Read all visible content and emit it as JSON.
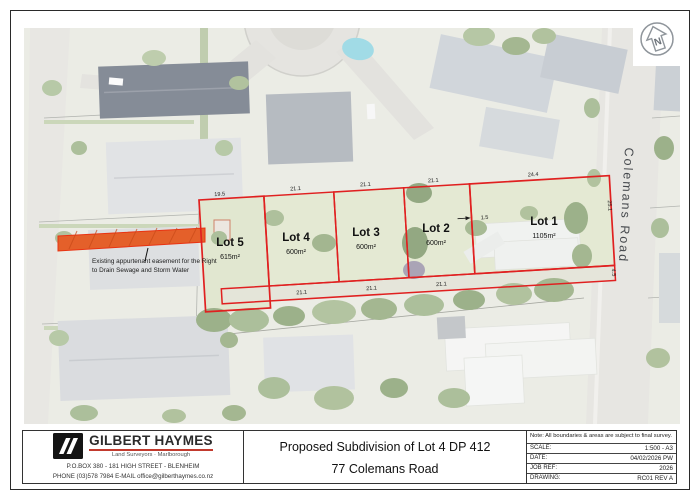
{
  "map": {
    "road_label": "Colemans Road",
    "north_letter": "N",
    "easement_note": "Existing appurtenant easement for the Right to Drain Sewage and Storm Water"
  },
  "lots": [
    {
      "name": "Lot 5",
      "area": "615m²"
    },
    {
      "name": "Lot 4",
      "area": "600m²"
    },
    {
      "name": "Lot 3",
      "area": "600m²"
    },
    {
      "name": "Lot 2",
      "area": "600m²"
    },
    {
      "name": "Lot 1",
      "area": "1105m²"
    }
  ],
  "dims": {
    "lot5_top": "19.5",
    "lot4_top": "21.1",
    "lot3_top": "21.1",
    "lot2_top": "21.1",
    "lot1_top": "24.4",
    "lot4_bottom": "21.1",
    "lot3_bottom": "21.1",
    "lot2_bottom": "21.1",
    "lot1_gap": "1.5",
    "lot1_road": "25.1",
    "strip_road": "4.5"
  },
  "title_block": {
    "company": "GILBERT HAYMES",
    "tagline": "Land Surveyors · Marlborough",
    "address": "P.O.BOX 380 - 181 HIGH STREET - BLENHEIM",
    "contact": "PHONE (03)578 7984 E-MAIL office@gilberthaymes.co.nz",
    "title_line1": "Proposed Subdivision of Lot 4 DP 412",
    "title_line2": "77 Colemans Road",
    "note": "Note: All boundaries & areas are subject to final survey.",
    "rows": [
      {
        "label": "SCALE:",
        "value": "1:500 - A3"
      },
      {
        "label": "DATE:",
        "value": "04/02/2026 PW"
      },
      {
        "label": "JOB REF:",
        "value": "2026"
      },
      {
        "label": "DRAWING:",
        "value": "RC01 REV A"
      }
    ]
  },
  "colors": {
    "boundary_red": "#e02020",
    "easement_orange": "#e4602a",
    "brand_underline": "#c23a2e",
    "aerial_base": "#e8e9e1"
  }
}
